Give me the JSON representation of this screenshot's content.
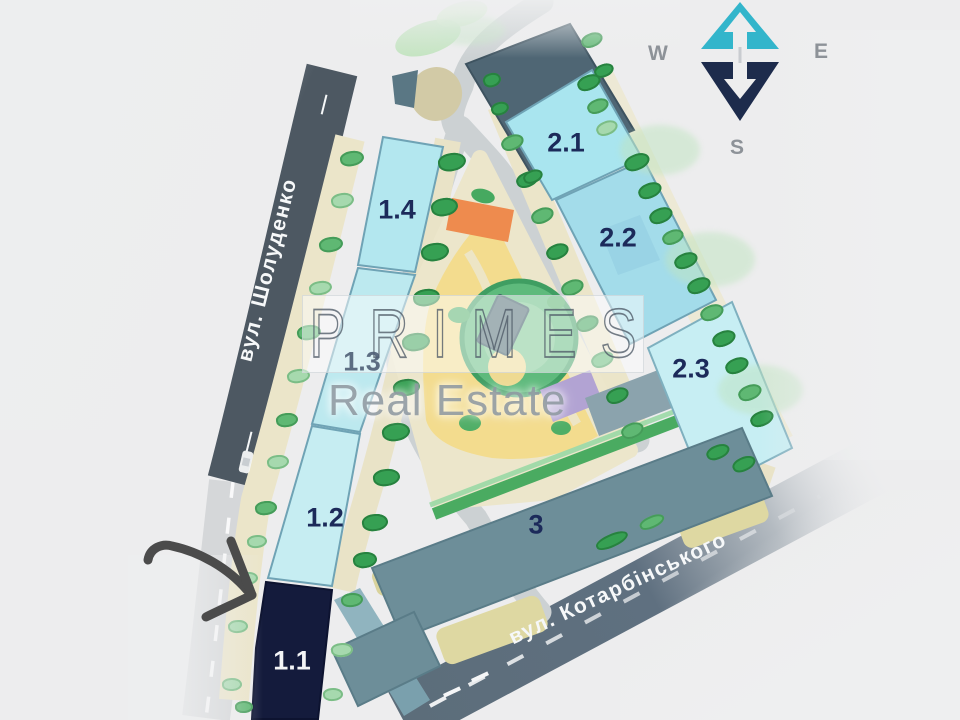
{
  "watermark": {
    "brand": "PRIMES",
    "subtitle": "Real Estate"
  },
  "compass": {
    "west": "W",
    "east": "E",
    "south": "S"
  },
  "streets": {
    "sholudenko": {
      "name": "вул. Шолуденко",
      "dash": "—"
    },
    "kotarbinskogo": {
      "name": "вул. Котарбінського",
      "dash": "—"
    }
  },
  "buildings": {
    "b11": {
      "label": "1.1",
      "highlighted": true
    },
    "b12": {
      "label": "1.2"
    },
    "b13": {
      "label": "1.3"
    },
    "b14": {
      "label": "1.4"
    },
    "b21": {
      "label": "2.1"
    },
    "b22": {
      "label": "2.2"
    },
    "b23": {
      "label": "2.3"
    },
    "b3": {
      "label": "3"
    }
  },
  "colors": {
    "building_cyan": "#b3e7ef",
    "building_highlight_navy": "#141b3c",
    "building_slate": "#6d8e99",
    "label_navy": "#1c2a5a",
    "compass_teal": "#33b5cb",
    "compass_navy": "#1d2b4c",
    "road_dark": "#4d5862",
    "park_yellow": "#f3dc8e",
    "park_orange": "#ee8b4e"
  }
}
